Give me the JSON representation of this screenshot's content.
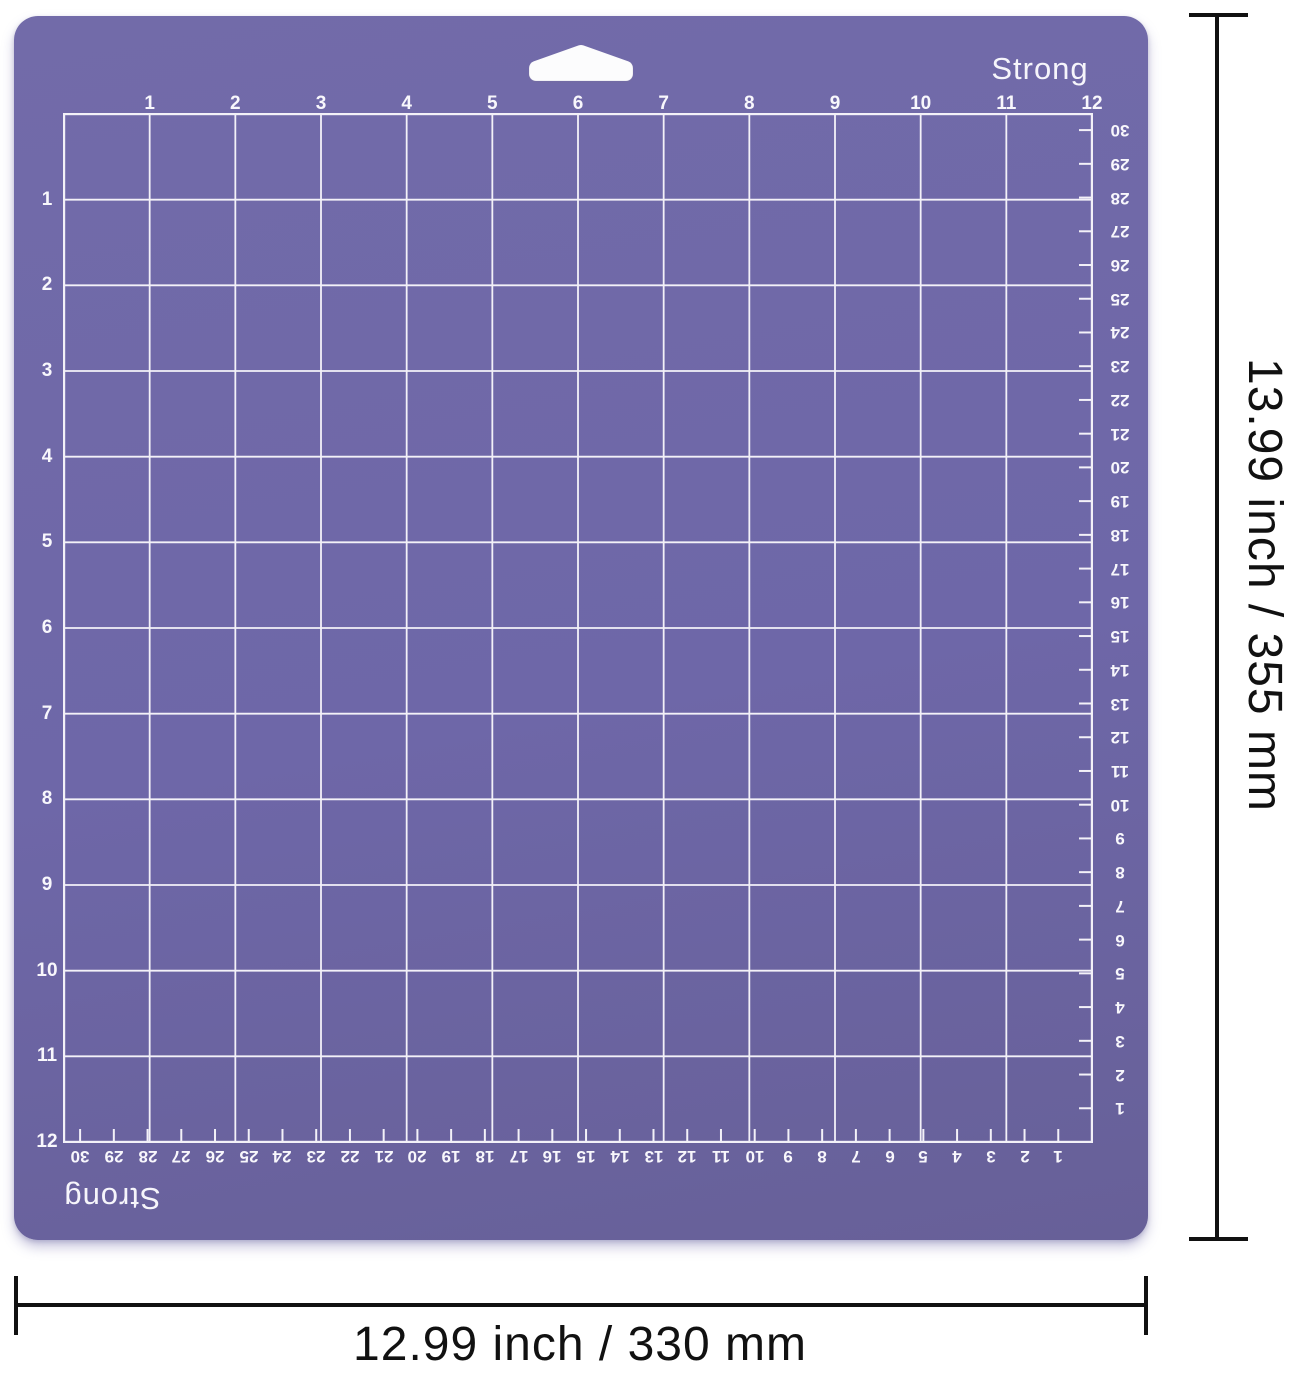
{
  "mat": {
    "brand_label_top": "Strong",
    "brand_label_bottom": "Strong",
    "mat_color": "#6e67a8",
    "grid_line_color": "#f3f1f8",
    "number_color": "#f8f7fc"
  },
  "rulers": {
    "top_inches": [
      "1",
      "2",
      "3",
      "4",
      "5",
      "6",
      "7",
      "8",
      "9",
      "10",
      "11",
      "12"
    ],
    "left_inches": [
      "1",
      "2",
      "3",
      "4",
      "5",
      "6",
      "7",
      "8",
      "9",
      "10",
      "11",
      "12"
    ],
    "right_cm_top_to_bottom": [
      "30",
      "29",
      "28",
      "27",
      "26",
      "25",
      "24",
      "23",
      "22",
      "21",
      "20",
      "19",
      "18",
      "17",
      "16",
      "15",
      "14",
      "13",
      "12",
      "11",
      "10",
      "9",
      "8",
      "7",
      "6",
      "5",
      "4",
      "3",
      "2",
      "1"
    ],
    "bottom_cm_left_to_right": [
      "30",
      "29",
      "28",
      "27",
      "26",
      "25",
      "24",
      "23",
      "22",
      "21",
      "20",
      "19",
      "18",
      "17",
      "16",
      "15",
      "14",
      "13",
      "12",
      "11",
      "10",
      "9",
      "8",
      "7",
      "6",
      "5",
      "4",
      "3",
      "2",
      "1"
    ]
  },
  "dimension_annotations": {
    "height_label": "13.99 inch / 355 mm",
    "width_label": "12.99 inch / 330 mm",
    "line_color": "#111111"
  }
}
